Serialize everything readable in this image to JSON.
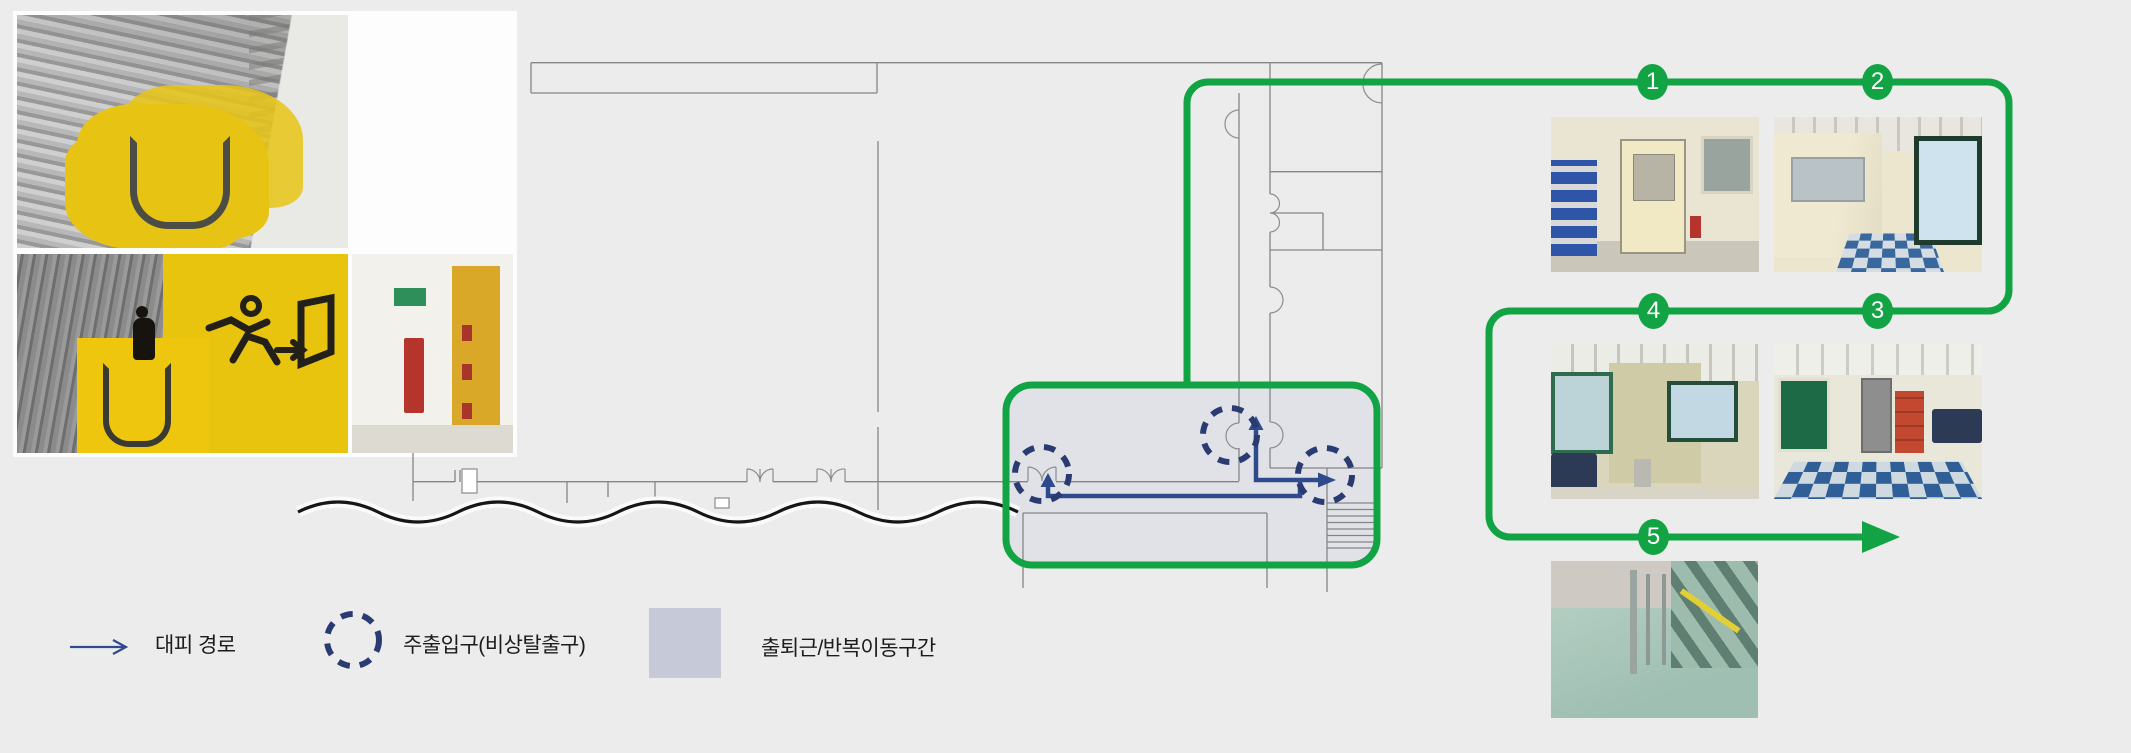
{
  "legend": {
    "items": [
      {
        "label": "대피 경로",
        "symbol": "route-arrow-icon",
        "color": "#304a8e"
      },
      {
        "label": "주출입구(비상탈출구)",
        "symbol": "dashed-circle-icon",
        "color": "#2a3b72"
      },
      {
        "label": "출퇴근/반복이동구간",
        "symbol": "zone-square-icon",
        "color": "#c5c9d8"
      }
    ]
  },
  "route": {
    "markers": [
      {
        "number": "1"
      },
      {
        "number": "2"
      },
      {
        "number": "3"
      },
      {
        "number": "4"
      },
      {
        "number": "5"
      }
    ]
  },
  "colors": {
    "background": "#ececec",
    "accent_green": "#12a344",
    "route_blue": "#304a8e",
    "exit_navy": "#2a3b72",
    "zone_fill": "#c5c9d8",
    "plan_line": "#858585"
  }
}
